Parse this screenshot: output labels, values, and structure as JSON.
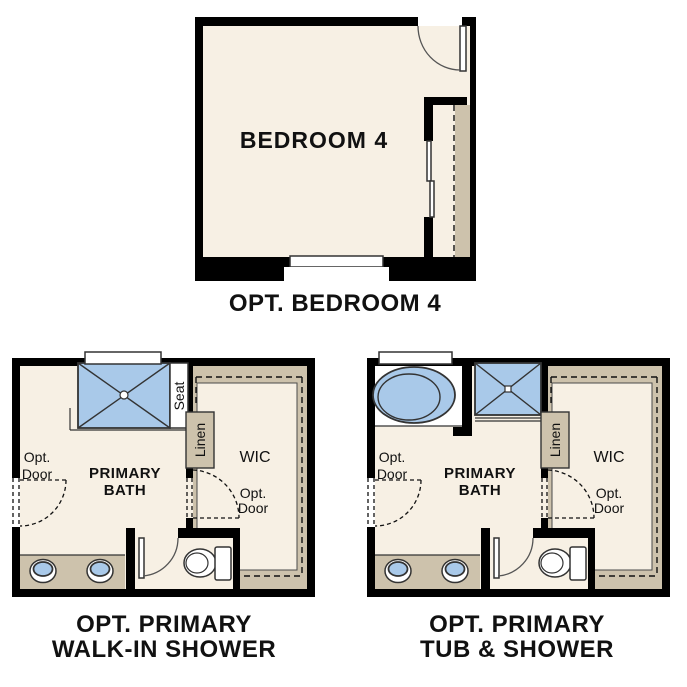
{
  "colors": {
    "wall": "#000000",
    "floor": "#f7f0e4",
    "tile": "#cdc2ac",
    "fixture": "#a9c9e9",
    "line": "#333333",
    "ink": "#111111",
    "paper": "#ffffff"
  },
  "plans": {
    "bedroom": {
      "room_label": "BEDROOM 4",
      "caption": "OPT. BEDROOM 4"
    },
    "walk_in": {
      "bath_line1": "PRIMARY",
      "bath_line2": "BATH",
      "wic": "WIC",
      "linen": "Linen",
      "seat": "Seat",
      "opt_door_left_line1": "Opt.",
      "opt_door_left_line2": "Door",
      "opt_door_wic_line1": "Opt.",
      "opt_door_wic_line2": "Door",
      "caption_line1": "OPT. PRIMARY",
      "caption_line2": "WALK-IN SHOWER"
    },
    "tub_shower": {
      "bath_line1": "PRIMARY",
      "bath_line2": "BATH",
      "wic": "WIC",
      "linen": "Linen",
      "opt_door_left_line1": "Opt.",
      "opt_door_left_line2": "Door",
      "opt_door_wic_line1": "Opt.",
      "opt_door_wic_line2": "Door",
      "caption_line1": "OPT. PRIMARY",
      "caption_line2": "TUB & SHOWER"
    }
  }
}
